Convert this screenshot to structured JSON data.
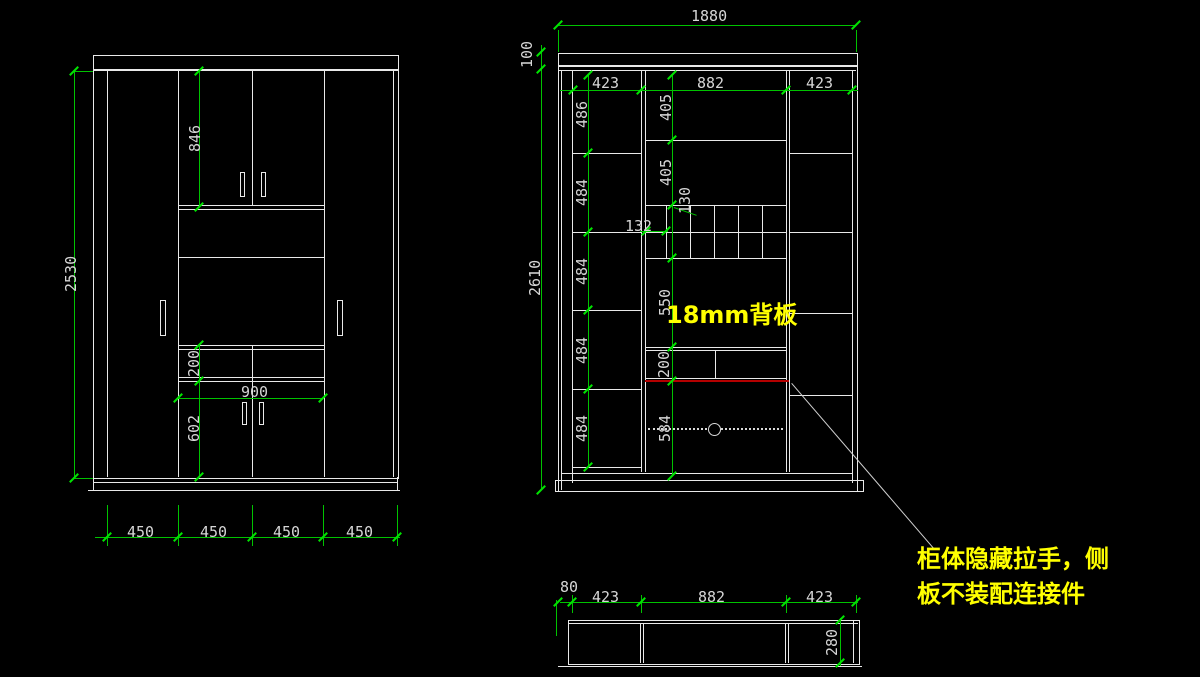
{
  "colors": {
    "background": "#000000",
    "panel_line": "#e9e9e9",
    "dimension_line": "#00c300",
    "dimension_text": "#d6d6d6",
    "highlight_text": "#ffff00",
    "alert_line": "#b40000"
  },
  "front_view": {
    "height": "2530",
    "upper_door_height": "846",
    "drawer_height": "200",
    "opening_width": "900",
    "lower_door_height": "602",
    "door_widths": [
      "450",
      "450",
      "450",
      "450"
    ]
  },
  "internal_view": {
    "total_width": "1880",
    "top_panel_height": "100",
    "body_height": "2610",
    "section_widths": [
      "423",
      "882",
      "423"
    ],
    "left_shelf_heights": [
      "486",
      "484",
      "484",
      "484",
      "484"
    ],
    "mid_heights": {
      "h1": "405",
      "h2": "405",
      "cubby_depth": "130",
      "cubby_width": "132",
      "h3": "550",
      "h4": "200",
      "h5": "584"
    },
    "back_panel_note": "18mm背板"
  },
  "top_view": {
    "edge_offset": "80",
    "section_widths": [
      "423",
      "882",
      "423"
    ],
    "depth": "280"
  },
  "annotation": {
    "line1": "柜体隐藏拉手，侧",
    "line2": "板不装配连接件"
  }
}
